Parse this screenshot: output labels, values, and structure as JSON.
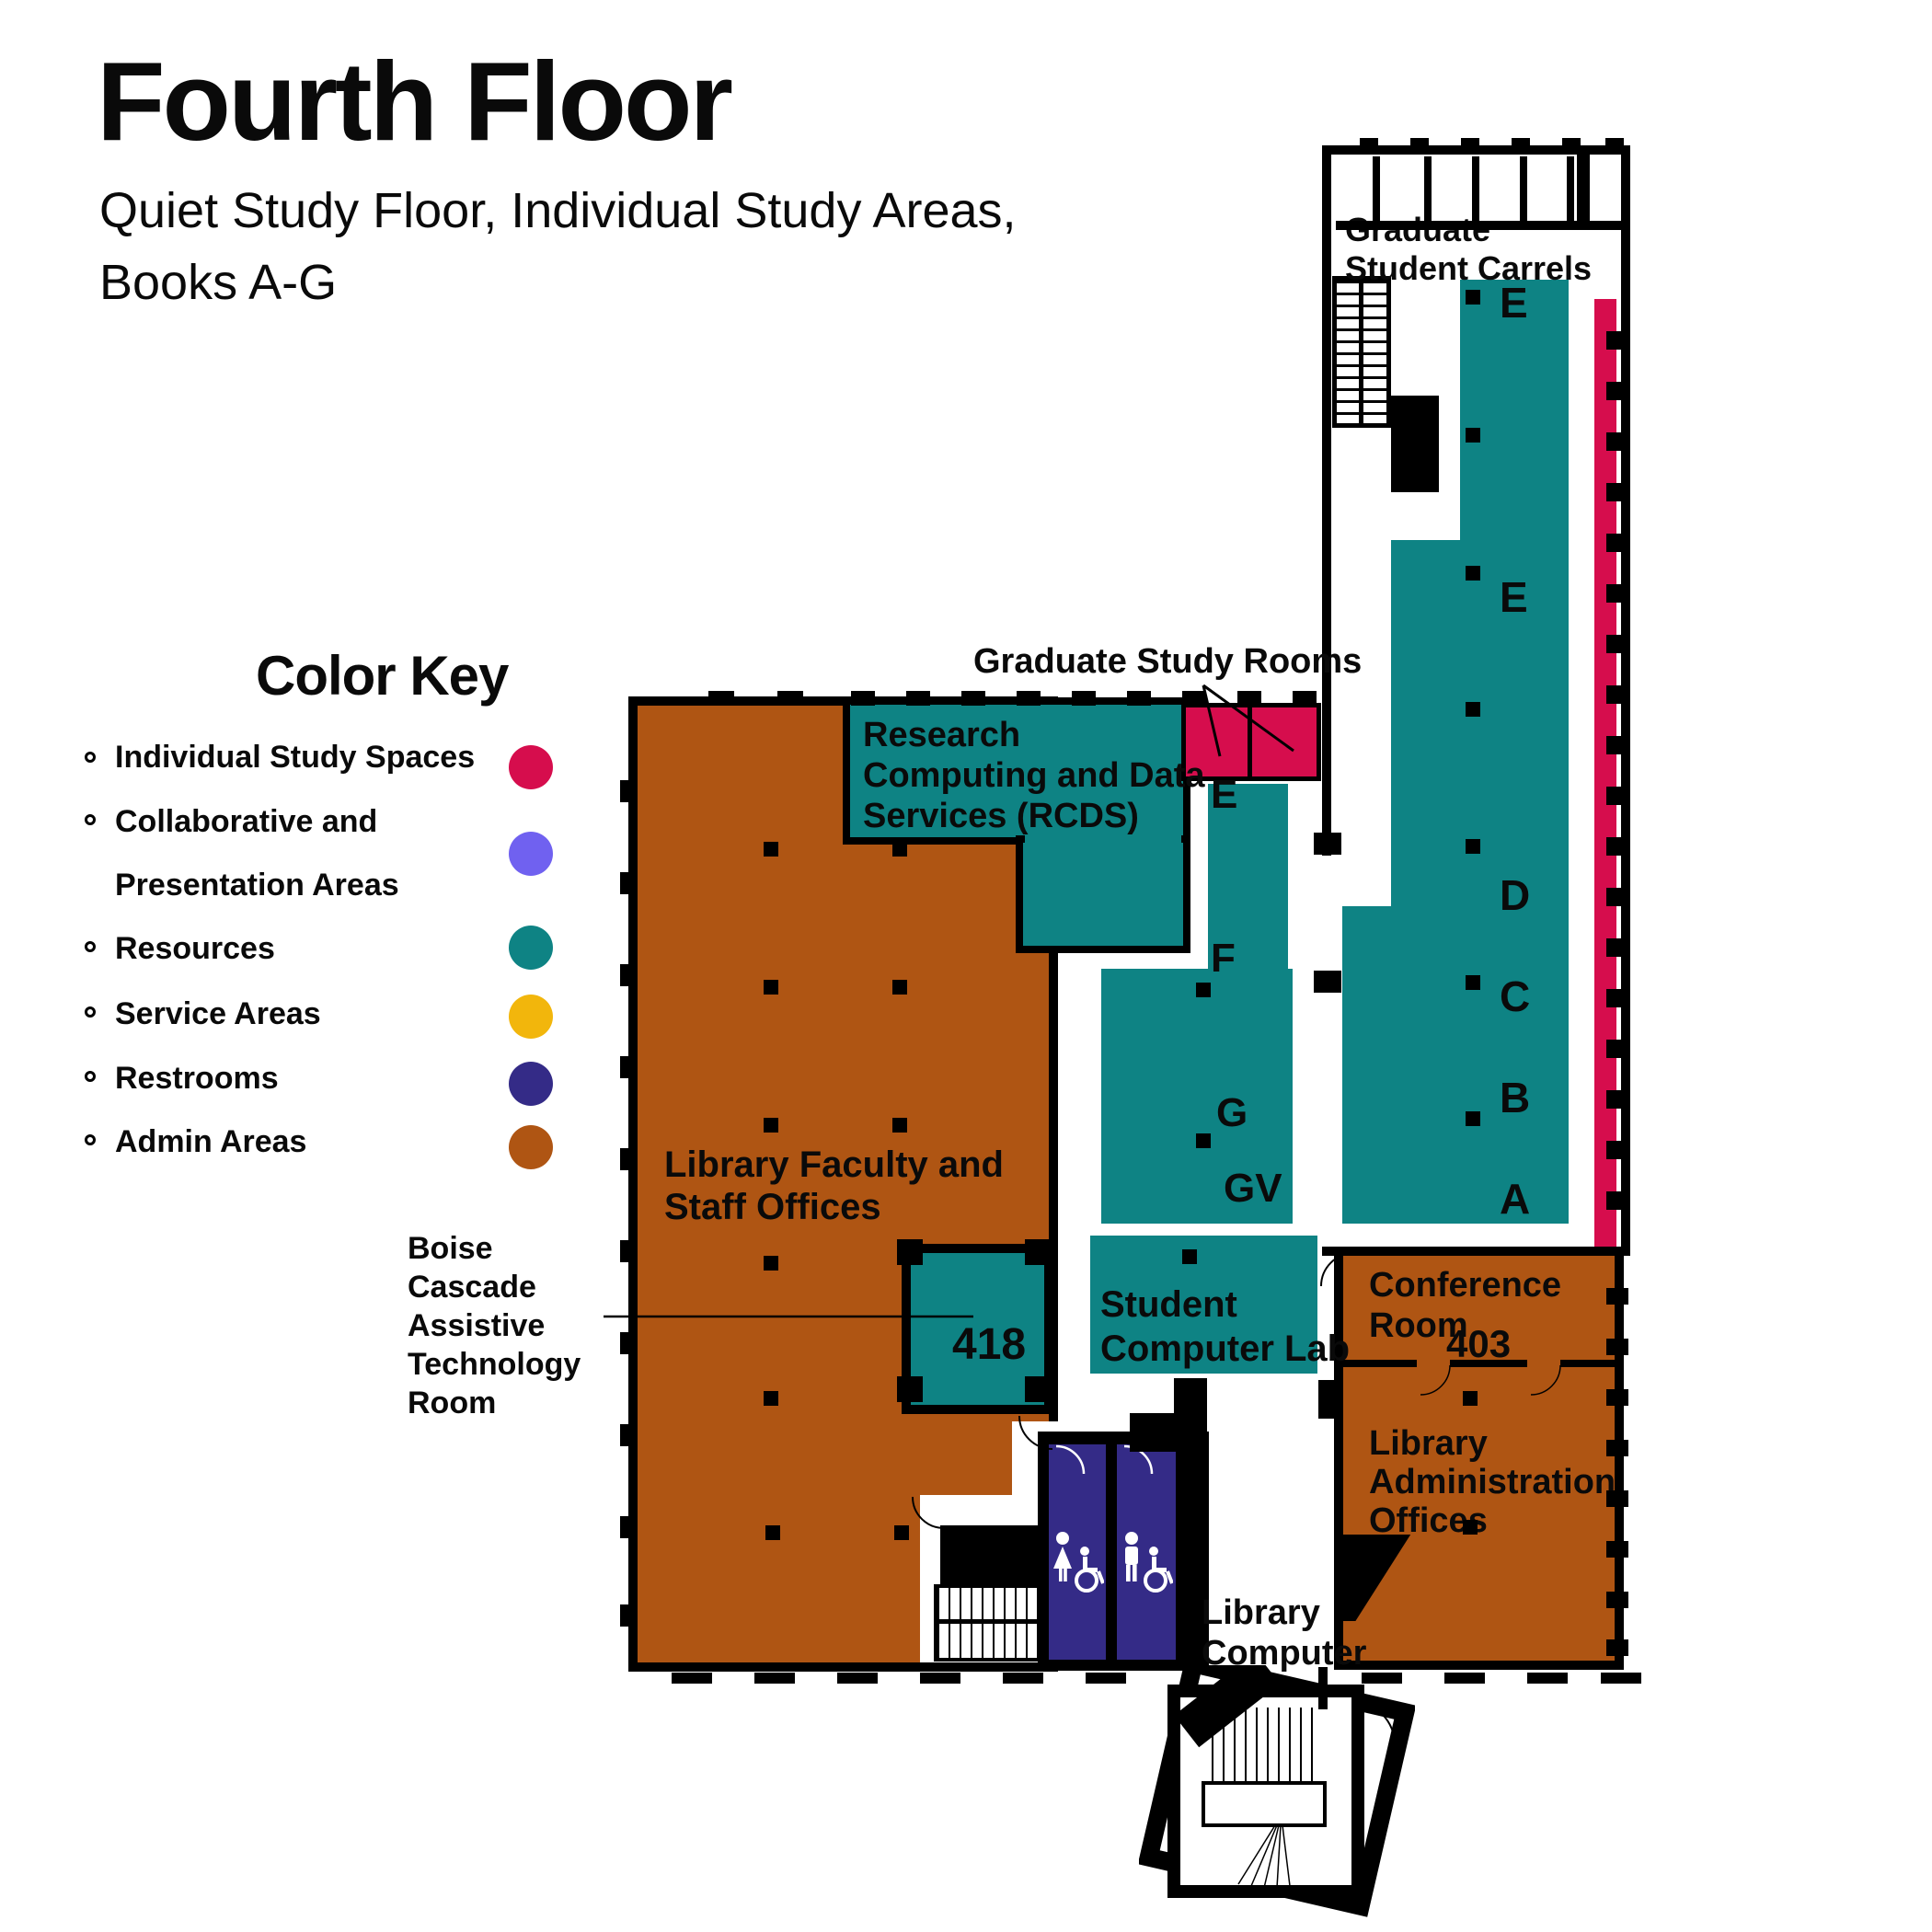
{
  "palette": {
    "individual_study": "#D60D4D",
    "collaborative": "#7061F0",
    "resources": "#0E8384",
    "service": "#F2B60C",
    "restrooms": "#342B87",
    "admin": "#AF5513",
    "wall": "#000000"
  },
  "header": {
    "title": "Fourth Floor",
    "subtitle_line1": "Quiet Study Floor, Individual Study Areas,",
    "subtitle_line2": "Books A-G"
  },
  "legend": {
    "heading": "Color Key",
    "items": [
      {
        "label": "Individual Study Spaces",
        "color": "#D60D4D"
      },
      {
        "label": "Collaborative and",
        "label2": "Presentation Areas",
        "color": "#7061F0"
      },
      {
        "label": "Resources",
        "color": "#0E8384"
      },
      {
        "label": "Service Areas",
        "color": "#F2B60C"
      },
      {
        "label": "Restrooms",
        "color": "#342B87"
      },
      {
        "label": "Admin Areas",
        "color": "#AF5513"
      }
    ]
  },
  "callout": {
    "line1": "Boise",
    "line2": "Cascade",
    "line3": "Assistive",
    "line4": "Technology",
    "line5": "Room"
  },
  "rooms": {
    "faculty": {
      "line1": "Library Faculty and",
      "line2": "Staff Offices"
    },
    "rcds": {
      "line1": "Research",
      "line2": "Computing and Data",
      "line3": "Services (RCDS)"
    },
    "grad_rooms": {
      "label": "Graduate Study Rooms"
    },
    "carrels": {
      "line1": "Graduate",
      "line2": "Student Carrels"
    },
    "room418": {
      "number": "418"
    },
    "lab": {
      "line1": "Student",
      "line2": "Computer Lab"
    },
    "conference": {
      "line1": "Conference",
      "line2": "Room",
      "number": "403"
    },
    "admin_offices": {
      "line1": "Library",
      "line2": "Administration",
      "line3": "Offices"
    },
    "library_computer": {
      "line1": "Library",
      "line2": "Computer"
    }
  },
  "stacks": {
    "tower": [
      "E",
      "E",
      "D",
      "C",
      "B",
      "A"
    ],
    "middle_e": "E",
    "middle_f": "F",
    "middle_g": "G",
    "middle_gv": "GV"
  },
  "icons": {
    "restroom_left": "female-and-wheelchair",
    "restroom_right": "male-and-wheelchair"
  }
}
